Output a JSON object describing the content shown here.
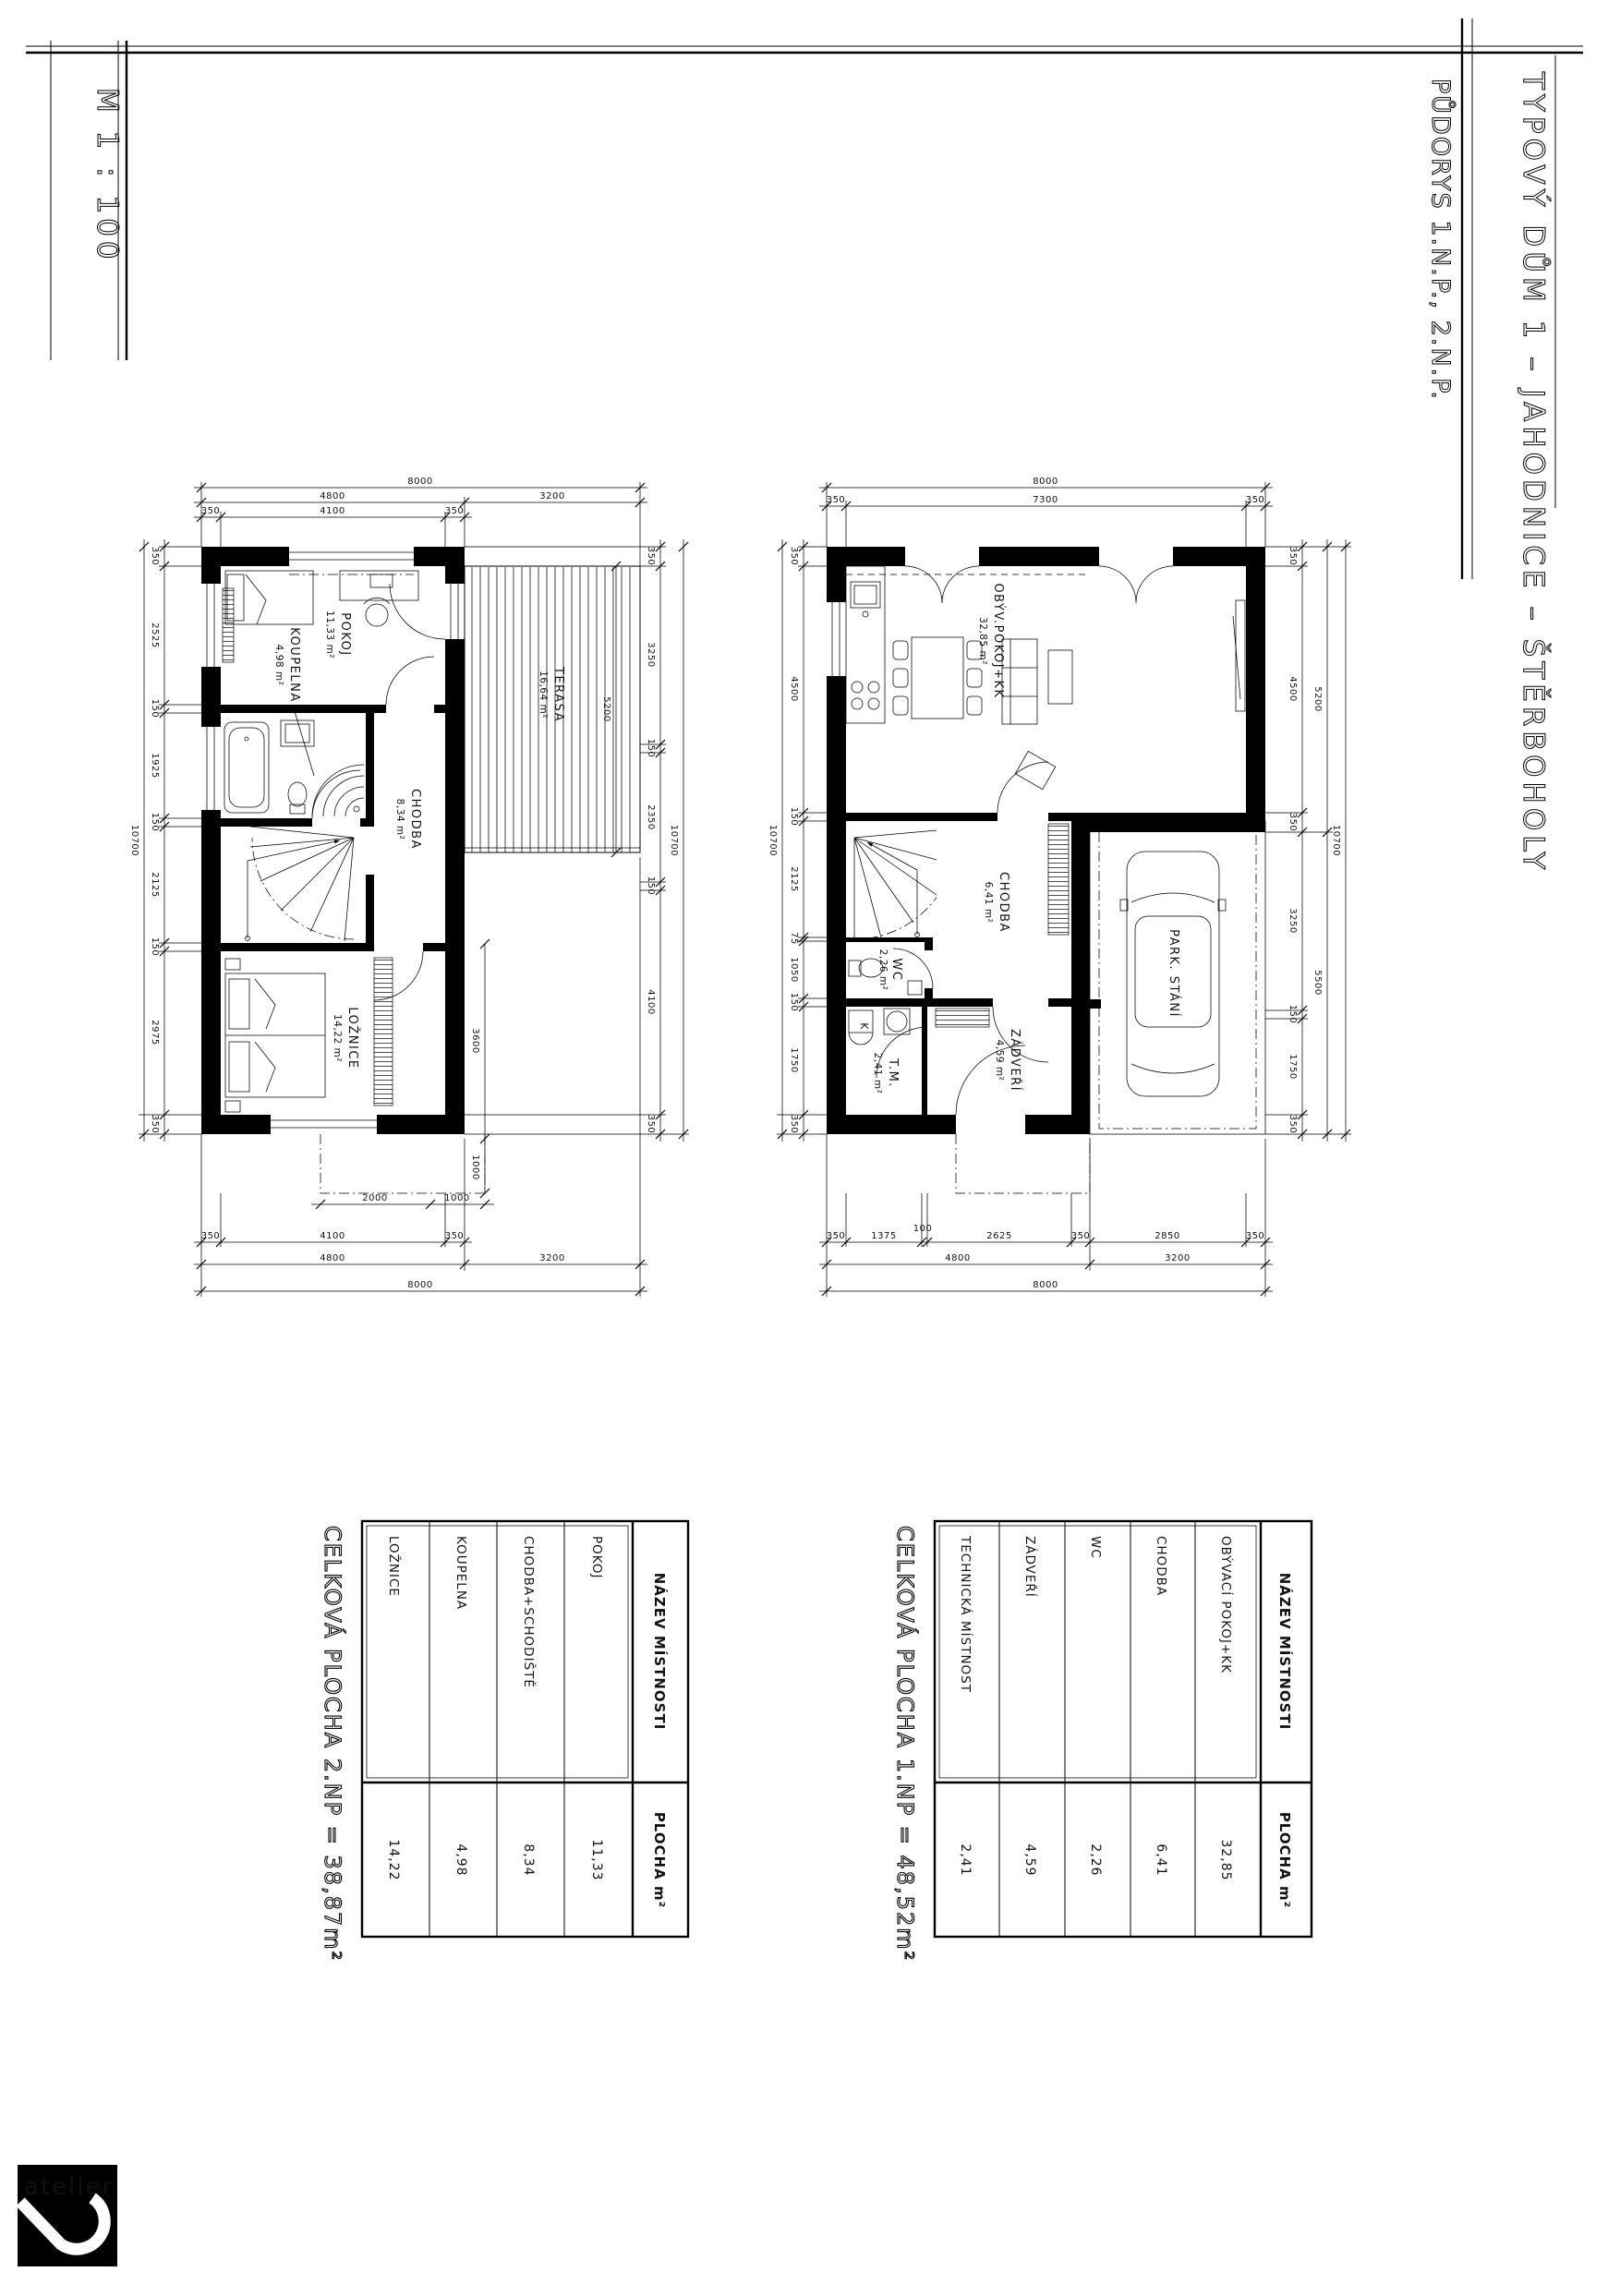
{
  "titles": {
    "scale": "M 1 : 100",
    "project": "TYPOVÝ DŮM 1 – JAHODNICE – ŠTĚRBOHOLY",
    "drawing": "PŮDORYS 1.N.P., 2.N.P."
  },
  "logo": {
    "text": "atelier"
  },
  "plans": {
    "np2": {
      "rooms": {
        "pokoj": {
          "name": "POKOJ",
          "area": "11,33 m²"
        },
        "koupelna": {
          "name": "KOUPELNA",
          "area": "4,98 m²"
        },
        "terasa": {
          "name": "TERASA",
          "area": "16,64 m²"
        },
        "chodba": {
          "name": "CHODBA",
          "area": "8,34 m²"
        },
        "loznice": {
          "name": "LOŽNICE",
          "area": "14,22 m²"
        }
      },
      "dims": {
        "top": [
          "8000",
          "4800",
          "3200",
          "350",
          "4100",
          "350"
        ],
        "left": [
          "350",
          "2525",
          "150",
          "1925",
          "150",
          "2125",
          "150",
          "2975",
          "350"
        ],
        "left_total": "10700",
        "right": [
          "350",
          "3250",
          "150",
          "2350",
          "150",
          "4100",
          "350"
        ],
        "right_terasa": "5200",
        "right_b": [
          "3600",
          "1000"
        ],
        "right_total": "10700",
        "bottom_inner": [
          "2000",
          "1000"
        ],
        "bottom": [
          "350",
          "4100",
          "350",
          "4800",
          "3200",
          "8000"
        ]
      }
    },
    "np1": {
      "rooms": {
        "obyv": {
          "name": "OBÝV.POKOJ+KK",
          "area": "32,85 m²"
        },
        "chodba": {
          "name": "CHODBA",
          "area": "6,41 m²"
        },
        "wc": {
          "name": "WC",
          "area": "2,26 m²"
        },
        "tm": {
          "name": "T.M.",
          "area": "2,41 m²"
        },
        "zadveri": {
          "name": "ZÁDVEŘÍ",
          "area": "4,59 m²"
        },
        "park": {
          "name": "PARK. STÁNÍ"
        },
        "k": {
          "name": "K"
        }
      },
      "dims": {
        "top": [
          "8000",
          "350",
          "7300",
          "350"
        ],
        "left": [
          "350",
          "4500",
          "150",
          "2125",
          "75",
          "1050",
          "150",
          "1750",
          "350"
        ],
        "left_total": "10700",
        "right": [
          "350",
          "4500",
          "350",
          "3250",
          "150",
          "1750",
          "350"
        ],
        "right_mid": [
          "5200",
          "5500"
        ],
        "right_total": "10700",
        "bottom": [
          "350",
          "1375",
          "100",
          "2625",
          "350",
          "2850",
          "350",
          "4800",
          "3200",
          "8000"
        ]
      }
    }
  },
  "tables": {
    "np2": {
      "header_name": "NÁZEV MÍSTNOSTI",
      "header_area": "PLOCHA m²",
      "rows": [
        {
          "name": "POKOJ",
          "area": "11,33"
        },
        {
          "name": "CHODBA+SCHODIŠTĚ",
          "area": "8,34"
        },
        {
          "name": "KOUPELNA",
          "area": "4,98"
        },
        {
          "name": "LOŽNICE",
          "area": "14,22"
        }
      ],
      "total": "CELKOVÁ PLOCHA  2.NP = 38,87m²"
    },
    "np1": {
      "header_name": "NÁZEV MÍSTNOSTI",
      "header_area": "PLOCHA m²",
      "rows": [
        {
          "name": "OBÝVACÍ POKOJ+KK",
          "area": "32,85"
        },
        {
          "name": "CHODBA",
          "area": "6,41"
        },
        {
          "name": "WC",
          "area": "2,26"
        },
        {
          "name": "ZÁDVEŘÍ",
          "area": "4,59"
        },
        {
          "name": "TECHNICKÁ MÍSTNOST",
          "area": "2,41"
        }
      ],
      "total": "CELKOVÁ PLOCHA  1.NP = 48,52m²"
    }
  }
}
